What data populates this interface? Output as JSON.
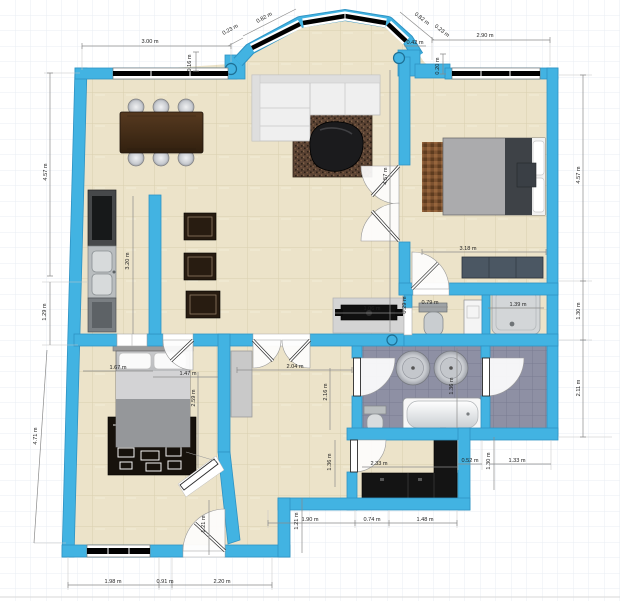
{
  "plan": {
    "title": "apartment-floor-plan",
    "canvas": {
      "width": 620,
      "height": 601
    }
  },
  "palette": {
    "wall": "#42b3e2",
    "wall_edge": "#2e93c4",
    "floor": "#ece3c9",
    "floor_grout": "#d9cfae",
    "bath_tile": "#8e90a4",
    "bath_grout": "#797c92",
    "window_glass": "#000000",
    "dim_line": "#8a8a8a",
    "dim_text": "#222222",
    "grid": "#e9eef3",
    "column": "#42b3e2"
  },
  "dims": {
    "top_left_width": "3.00 m",
    "top_right_width": "2.90 m",
    "bay_left_diagonal": "0.82 m",
    "bay_left_offset": "0.23 m",
    "bay_left_depth": "0.16 m",
    "bay_right_diagonal": "0.82 m",
    "bay_right_offset": "0.23 m",
    "bay_right_width": "0.42 m",
    "bay_right_depth": "0.20 m",
    "left_upper_height": "4.57 m",
    "left_mid_height": "1.29 m",
    "left_lower_height": "4.71 m",
    "right_upper_height": "4.57 m",
    "right_mid_height": "1.30 m",
    "right_lower_height": "2.11 m",
    "living_height": "4.57 m",
    "kitchen_run": "3.20 m",
    "bedroom1_width": "3.18 m",
    "shower_width": "1.39 m",
    "wc_width": "0.79 m",
    "wc_depth": "0.29 m",
    "tv_bench_width": "1.06 m",
    "hall_width": "2.04 m",
    "hall_height": "2.16 m",
    "bath_height": "1.36 m",
    "bed2_head_width": "1.67 m",
    "bed2_side_width": "1.47 m",
    "bed2_length": "2.59 m",
    "closet_room_width": "2.33 m",
    "closet_room_height": "1.36 m",
    "niche_width": "0.52 m",
    "storage_width": "1.33 m",
    "storage_height": "1.30 m",
    "hall_bottom_width": "1.90 m",
    "entry_width_1": "0.74 m",
    "entry_width_2": "1.48 m",
    "entry_depth_left": "1.21 m",
    "entry_depth_right": "1.21 m",
    "bottom_width_1": "1.98 m",
    "bottom_width_2": "0.91 m",
    "bottom_width_3": "2.20 m"
  }
}
